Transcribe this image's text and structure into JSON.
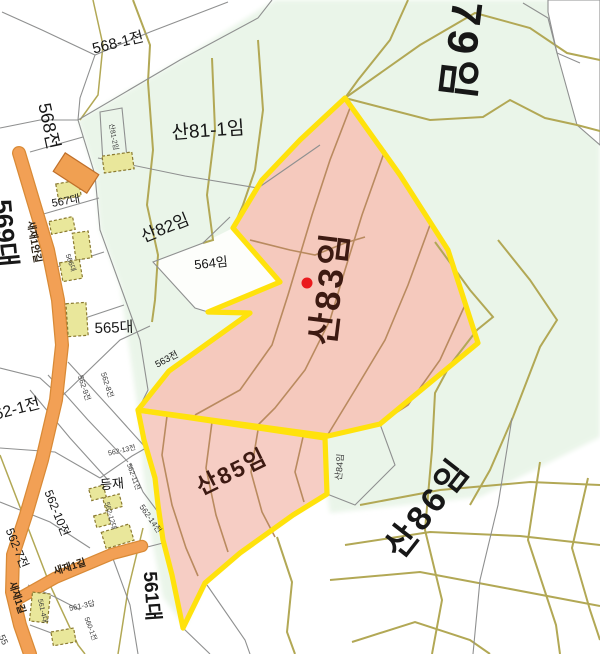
{
  "map": {
    "type": "cadastral-parcel-map",
    "highlighted_parcels": [
      "산83임",
      "산85임"
    ],
    "marker": "red-dot",
    "colors": {
      "highlight_fill": "#f5c9bd",
      "highlight_outline": "#ffe20c",
      "forest_fill": "#eaf5e9",
      "road_fill": "#f2a055",
      "building_fill": "#e9e79b",
      "contour_olive": "#b2a855",
      "contour_brown": "#b98a5f",
      "boundary_gray": "#8f9090",
      "marker_red": "#ea1a1e"
    }
  },
  "labels": {
    "p568_1": "568-1전",
    "p568": "568전",
    "p569": "569대",
    "p81_1": "산81-1임",
    "p81_2": "산81-2임",
    "p82": "산82임",
    "p79": "산79임",
    "p83": "산83임",
    "p84": "산84임",
    "p85": "산85임",
    "p86": "산86임",
    "p564": "564임",
    "p563": "563전",
    "p565": "565대",
    "p566": "566대",
    "p567": "567대",
    "p561": "561대",
    "p561_3": "561-3답",
    "p561_4": "561-4대",
    "p560_1": "560-1전",
    "p562_1": "562-1전",
    "p562_7": "562-7전",
    "p562_8": "562-8전",
    "p562_9": "562-9전",
    "p562_10": "562-10전",
    "p562_11": "562-11전",
    "p562_12": "562-12대",
    "p562_13": "562-13전",
    "p562_14": "562-14전",
    "p55": "55",
    "deungjae": "등재",
    "road_a": "새재1안길",
    "road_b": "새재1길",
    "road_c": "새재1길"
  }
}
